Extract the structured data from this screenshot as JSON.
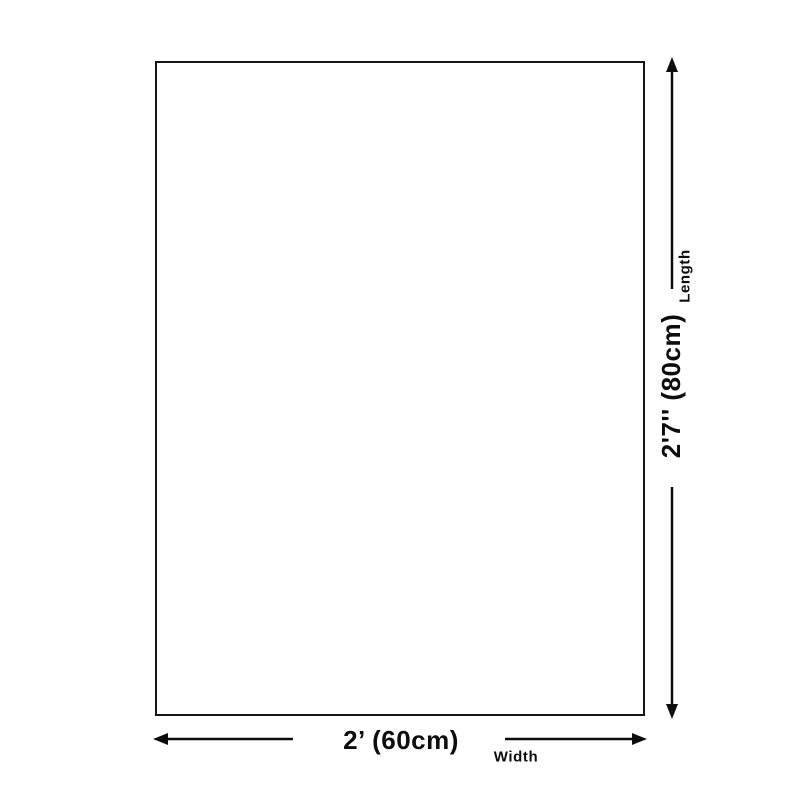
{
  "diagram": {
    "background_color": "#ffffff",
    "line_color": "#0d0d0d",
    "rect_border_color": "#161616",
    "length": {
      "value": "2'7'' (80cm)",
      "label": "Length"
    },
    "width": {
      "value": "2’ (60cm)",
      "label": "Width"
    }
  }
}
